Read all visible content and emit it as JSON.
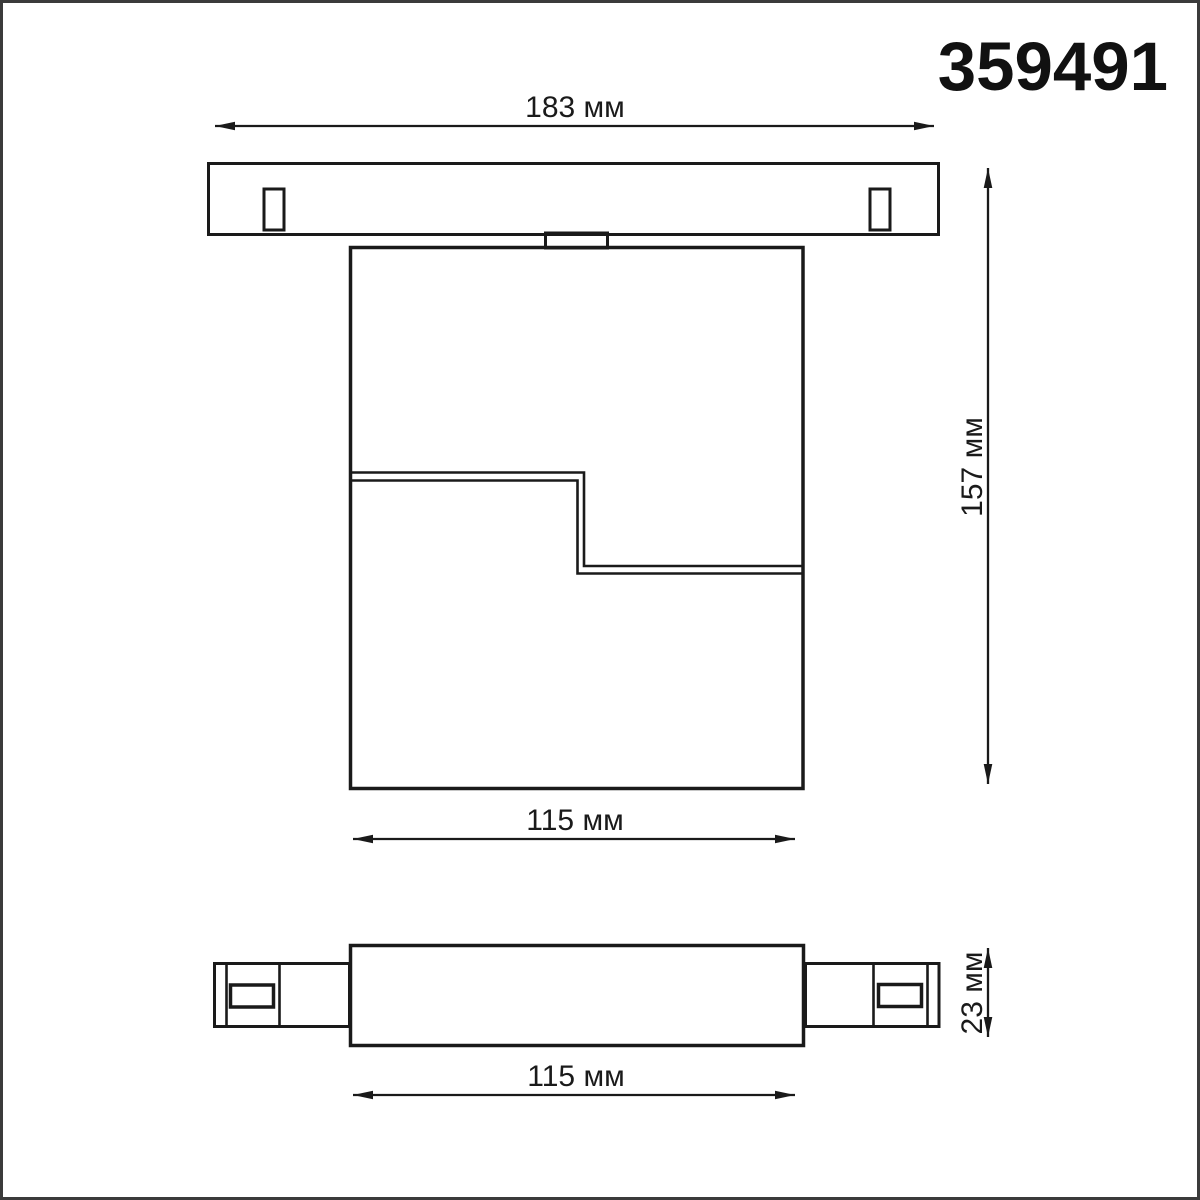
{
  "title": "359491",
  "colors": {
    "line": "#1a1a1a",
    "frame_border": "#3b3b3b",
    "background": "#ffffff"
  },
  "dimensions": {
    "track_width": "183 мм",
    "overall_height": "157 мм",
    "body_width": "115 мм",
    "body_length": "115 мм",
    "profile_height": "23 мм"
  }
}
